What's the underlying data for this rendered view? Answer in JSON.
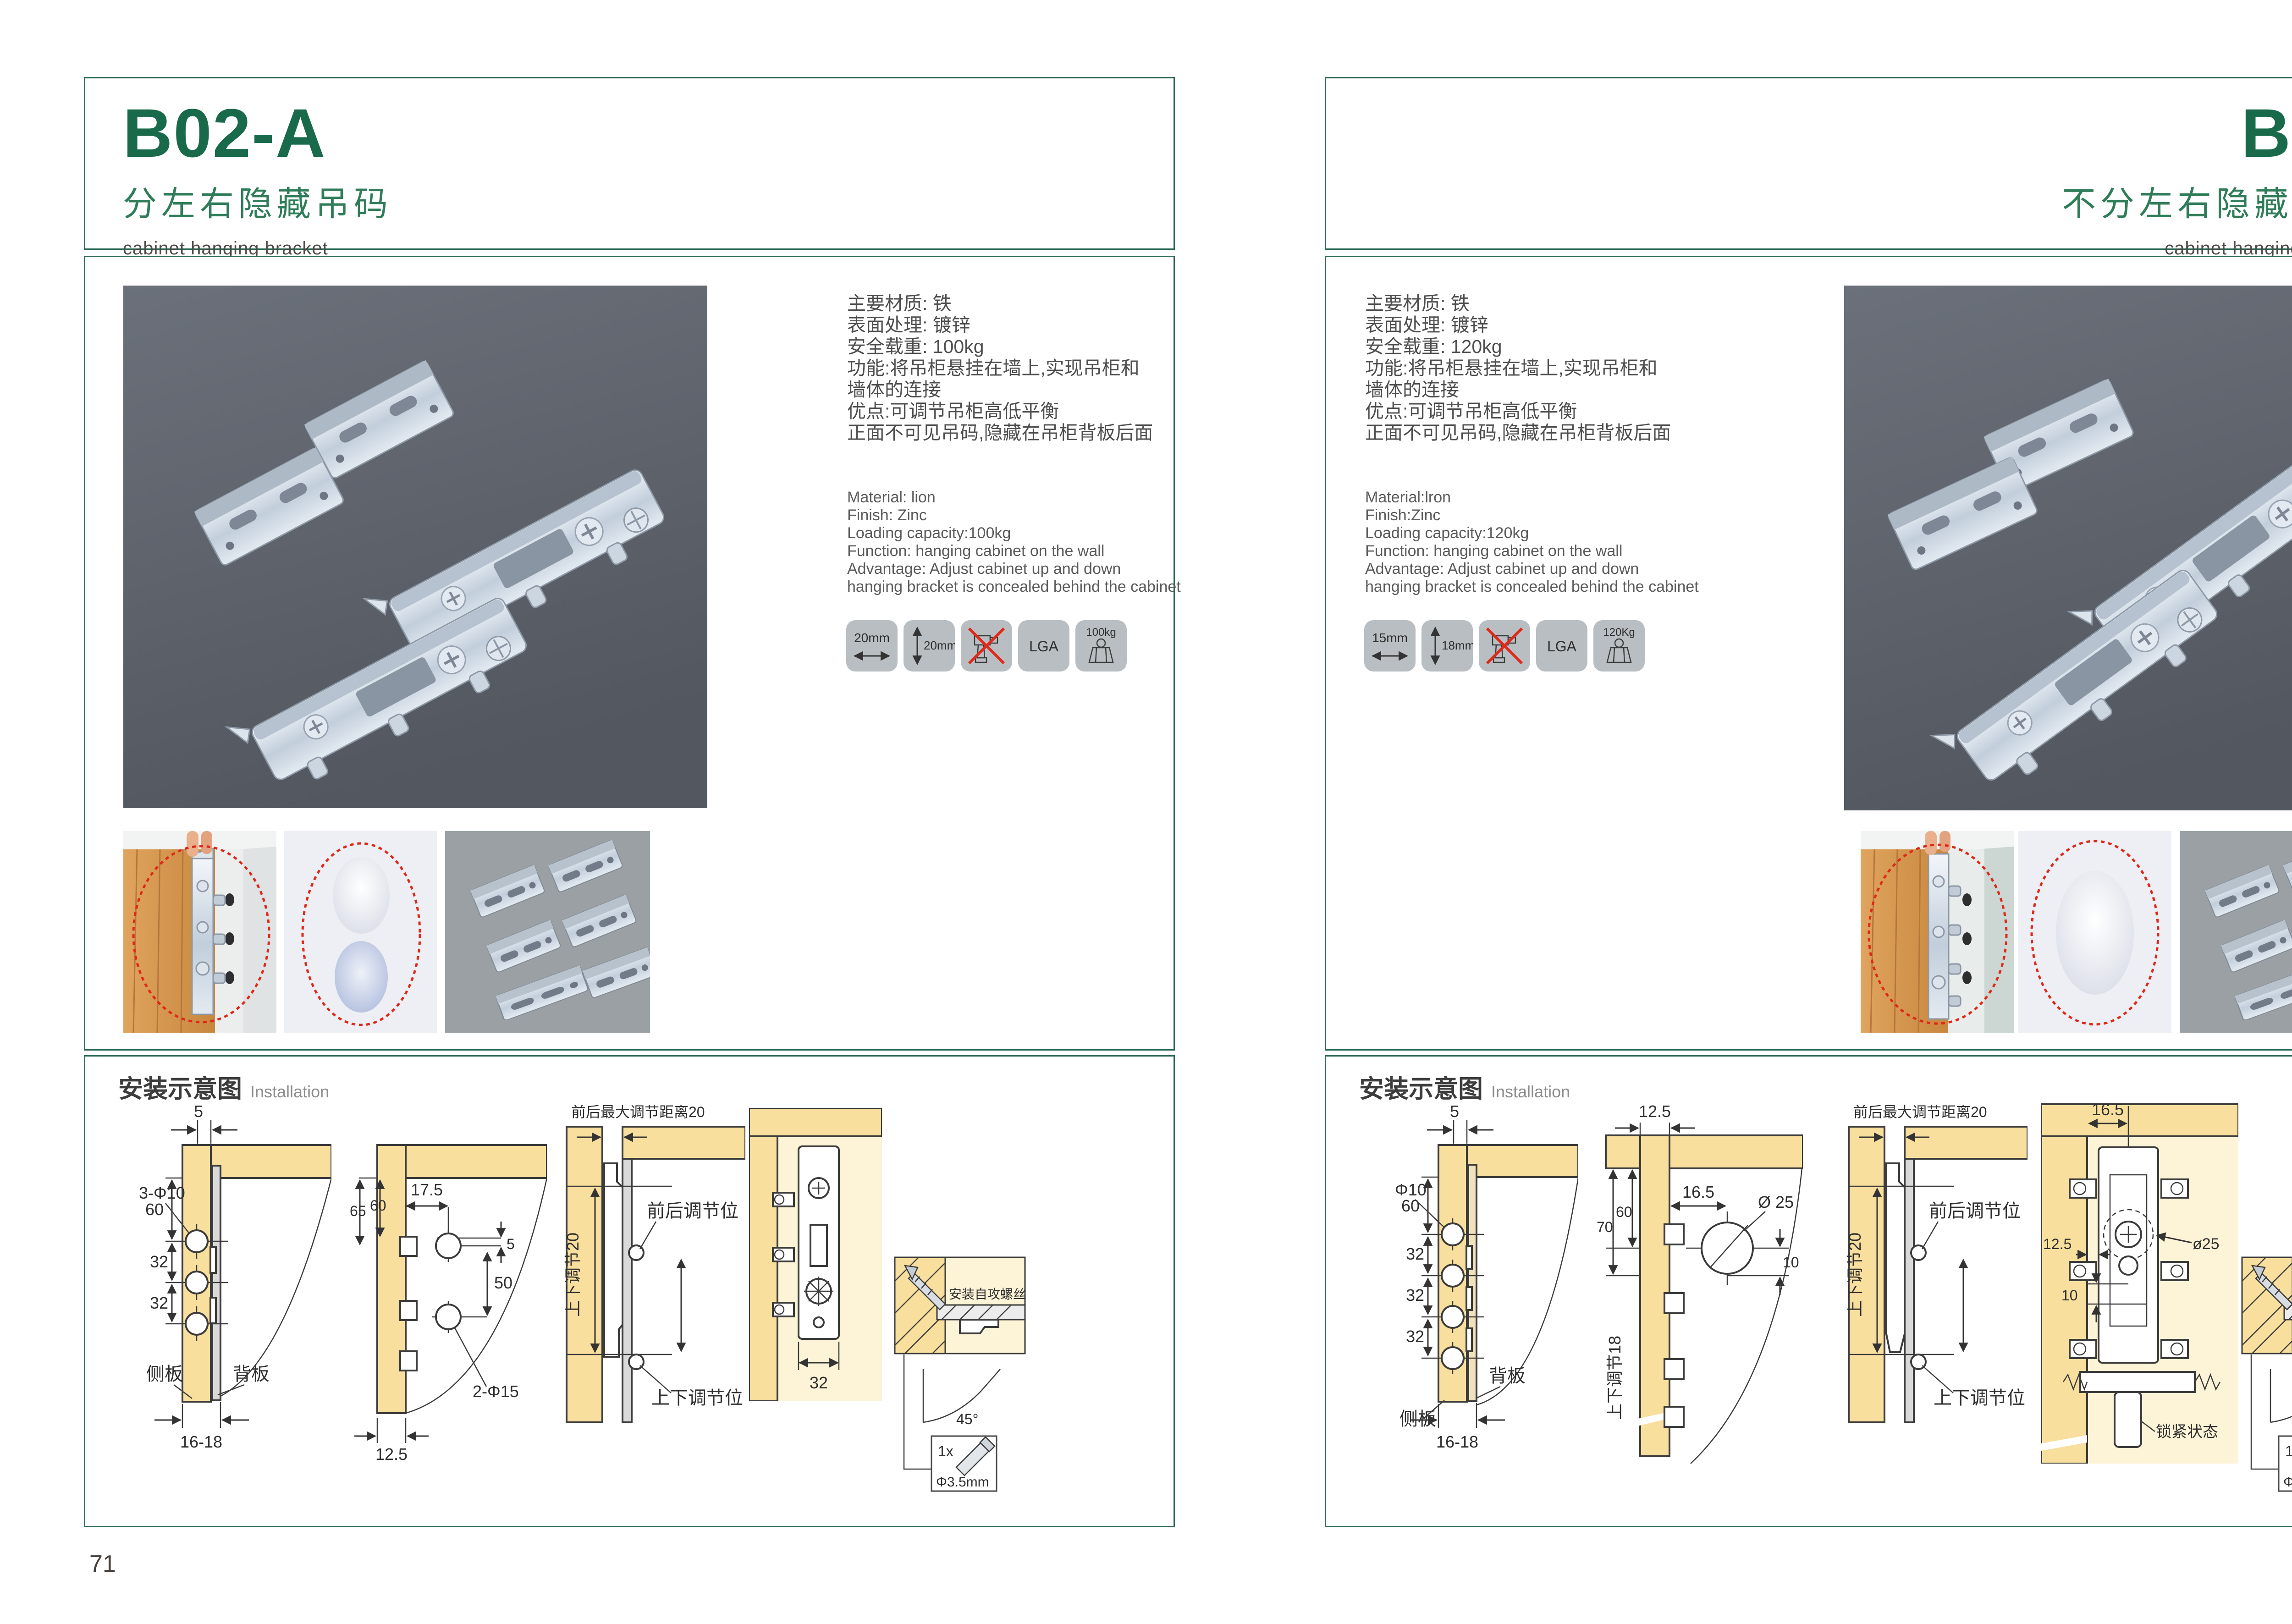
{
  "brand": {
    "accent_green": "#196a4b",
    "subtitle_green": "#2f7d58",
    "frame_green": "#2e6b59",
    "highlight_red": "#e02818"
  },
  "pages": [
    {
      "code": "B02-A",
      "title_cn": "分左右隐藏吊码",
      "title_en": "cabinet hanging bracket",
      "page_number": "71",
      "specs_cn": [
        "主要材质: 铁",
        "表面处理: 镀锌",
        "安全载重: 100kg",
        "功能:将吊柜悬挂在墙上,实现吊柜和",
        "墙体的连接",
        "优点:可调节吊柜高低平衡",
        "正面不可见吊码,隐藏在吊柜背板后面"
      ],
      "specs_en": [
        "Material: lion",
        "Finish: Zinc",
        "Loading capacity:100kg",
        "Function: hanging cabinet on the wall",
        "Advantage: Adjust cabinet up and down",
        "hanging bracket is concealed behind the cabinet"
      ],
      "badges": {
        "width": "20mm",
        "height": "20mm",
        "lga": "LGA",
        "load": "100kg"
      },
      "install": {
        "cn": "安装示意图",
        "en": "Installation"
      },
      "d1": {
        "top": "5",
        "h": "60",
        "hole": "3-Φ10",
        "s1": "32",
        "s2": "32",
        "side": "侧板",
        "back": "背板",
        "bottom": "16-18"
      },
      "d2": {
        "top": "17.5",
        "l1": "65",
        "l2": "60",
        "r1": "5",
        "r2": "50",
        "hole": "2-Φ15",
        "bottom": "12.5"
      },
      "d3": {
        "top": "前后最大调节距离20",
        "vert": "上下调节20",
        "front": "前后调节位",
        "updown": "上下调节位"
      },
      "d4": {
        "w": "32"
      },
      "d5": {
        "screw": "安装自攻螺丝",
        "angle": "45°",
        "qty": "1x",
        "dia": "Φ3.5mm"
      }
    },
    {
      "code": "B03",
      "title_cn": "不分左右隐藏吊码",
      "title_en": "cabinet hanging bracket",
      "page_number": "72",
      "specs_cn": [
        "主要材质: 铁",
        "表面处理: 镀锌",
        "安全载重: 120kg",
        "功能:将吊柜悬挂在墙上,实现吊柜和",
        "墙体的连接",
        "优点:可调节吊柜高低平衡",
        "正面不可见吊码,隐藏在吊柜背板后面"
      ],
      "specs_en": [
        "Material:lron",
        "Finish:Zinc",
        "Loading capacity:120kg",
        "Function: hanging cabinet on the wall",
        "Advantage: Adjust cabinet up and down",
        "hanging bracket is concealed behind the cabinet"
      ],
      "badges": {
        "width": "15mm",
        "height": "18mm",
        "lga": "LGA",
        "load": "120Kg"
      },
      "install": {
        "cn": "安装示意图",
        "en": "Installation"
      },
      "d1": {
        "top": "5",
        "h": "60",
        "hole": "Φ10",
        "s1": "32",
        "s2": "32",
        "s3": "32",
        "side": "侧板",
        "back": "背板",
        "bottom": "16-18"
      },
      "d2": {
        "top": "12.5",
        "l1": "70",
        "l2": "60",
        "r1": "16.5",
        "hole": "Ø 25",
        "r2": "10",
        "vert": "上下调节18"
      },
      "d3": {
        "top": "前后最大调节距离20",
        "vert": "上下调节20",
        "front": "前后调节位",
        "updown": "上下调节位"
      },
      "d4": {
        "top": "16.5",
        "l1": "12.5",
        "l2": "10",
        "hole": "ø25",
        "lock": "锁紧状态"
      },
      "d5": {
        "screw": "安装自攻螺丝",
        "angle": "45°",
        "qty": "1x",
        "dia": "Φ3.5mm"
      }
    }
  ]
}
